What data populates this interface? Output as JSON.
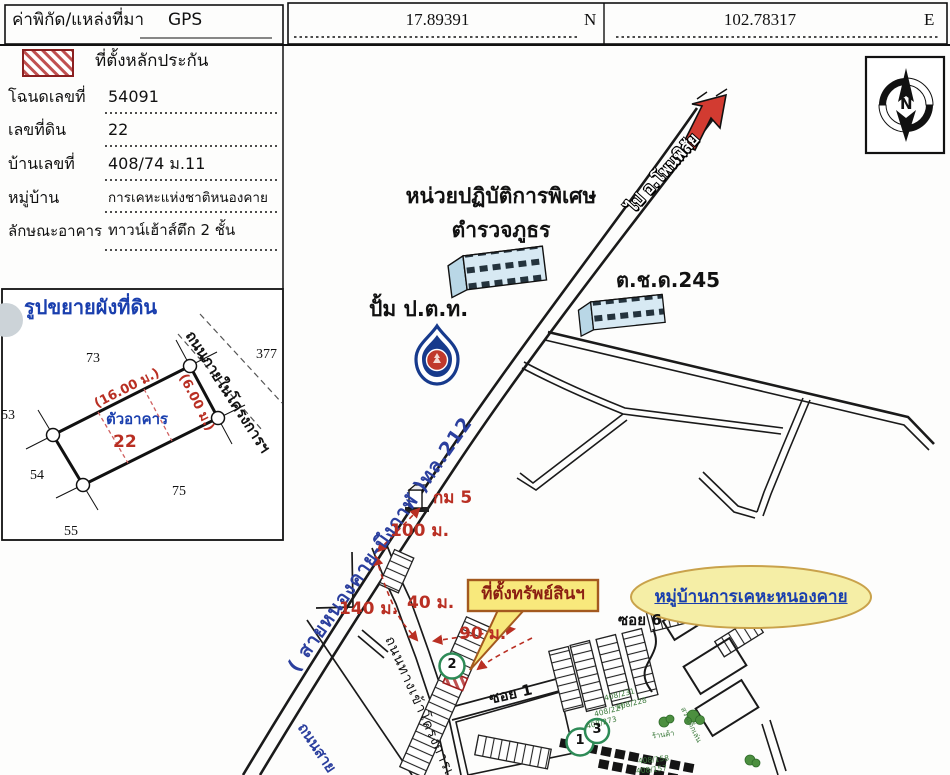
{
  "header": {
    "label": "ค่าพิกัด/แหล่งที่มา",
    "source": "GPS",
    "latitude": "17.89391",
    "lat_dir": "N",
    "longitude": "102.78317",
    "lon_dir": "E"
  },
  "legend": {
    "hatch_label": "ที่ตั้งหลักประกัน"
  },
  "property": {
    "deed_label": "โฉนดเลขที่",
    "deed_no": "54091",
    "parcel_label": "เลขที่ดิน",
    "parcel_no": "22",
    "house_label": "บ้านเลขที่",
    "house_no": "408/74 ม.11",
    "village_label": "หมู่บ้าน",
    "village": "การเคหะแห่งชาติหนองคาย",
    "building_label": "ลักษณะอาคาร",
    "building": "ทาวน์เฮ้าส์ตึก 2 ชั้น"
  },
  "plot": {
    "title": "รูปขยายผังที่ดิน",
    "building_text": "ตัวอาคาร",
    "parcel_no": "22",
    "width_dim": "(16.00 ม.)",
    "depth_dim": "(6.00 ม.)",
    "road": "ถนนภายในโครงการฯ",
    "adjacent": {
      "n73": "73",
      "n377": "377",
      "n53": "53",
      "n54": "54",
      "n75": "75",
      "n55": "55"
    }
  },
  "map": {
    "compass_n": "N",
    "highway": "( สายหนองคาย-บึงกาฬ )ทล.212",
    "direction": "ไป อ.โพนพิสัย",
    "police1": "หน่วยปฏิบัติการพิเศษ",
    "police2": "ตำรวจภูธร",
    "ptt": "ปั้ม ป.ต.ท.",
    "tcd": "ต.ช.ด.245",
    "km": "กม 5",
    "d100": "100 ม.",
    "d140": "140 ม.",
    "d40": "40 ม.",
    "d90": "90 ม.",
    "callout": "ที่ตั้งทรัพย์สินฯ",
    "village": "หมู่บ้านการเคหะหนองคาย",
    "soi1": "ซอย 1",
    "soi6": "ซอย 6",
    "entry_road": "ถนนทางเข้าโครงการเคหะฯ",
    "bottom_road": "ถนนสาย",
    "m1": "1",
    "m2": "2",
    "m3": "3",
    "shop": "ร้านค้า",
    "playground": "สวนเด็กเล่น",
    "hn1": "408/231",
    "hn2": "408/228",
    "hn3": "408/227",
    "hn4": "408/273",
    "hn5": "408/158",
    "hn6": "408/157"
  },
  "colors": {
    "accent_red": "#b92f23",
    "road_blue": "#2b3f9e",
    "callout_yellow": "#f8e97c",
    "ellipse_yellow": "#f5eea6",
    "marker_green": "#2e8b57"
  }
}
